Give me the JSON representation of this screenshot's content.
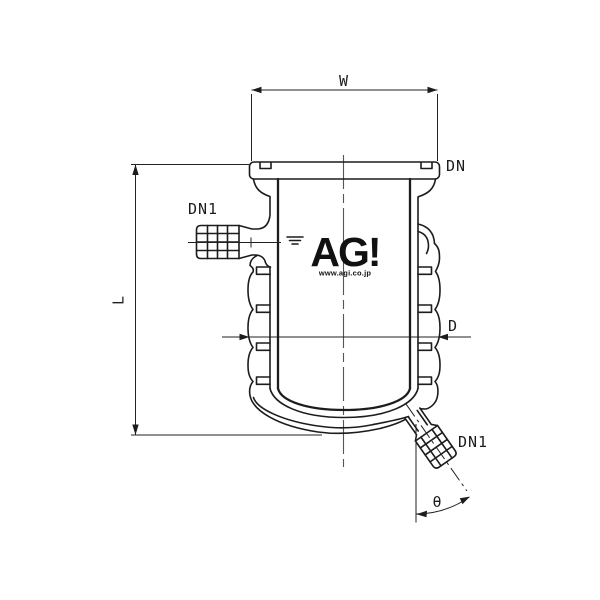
{
  "drawing": {
    "background": "#ffffff",
    "line_color": "#1c1c1c",
    "labels": {
      "width": "W",
      "neck_size": "DN",
      "side_port": "DN1",
      "length": "L",
      "diameter": "D",
      "drain_port": "DN1",
      "drain_angle": "θ"
    },
    "logo": {
      "text": "AG!",
      "url": "www.agi.co.jp"
    }
  }
}
